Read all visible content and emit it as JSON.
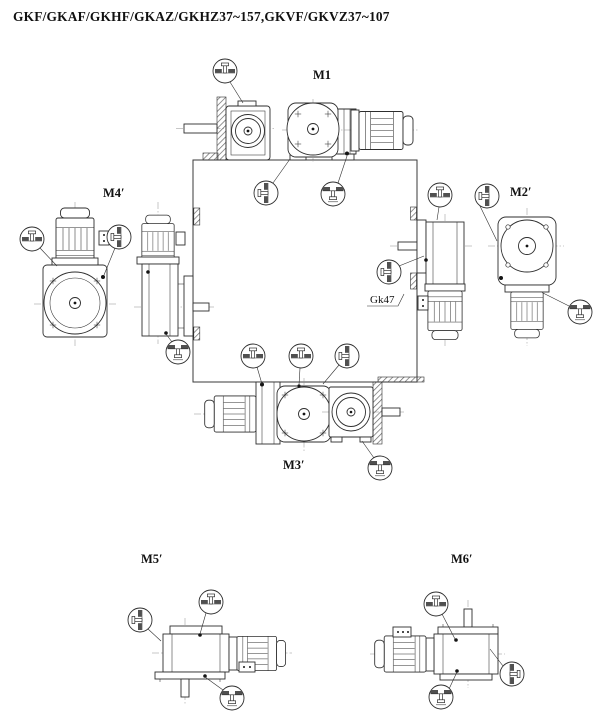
{
  "title": "GKF/GKAF/GKHF/GKAZ/GKHZ37~157,GKVF/GKVZ37~107",
  "mounting_positions": {
    "m1": "M1",
    "m2": "M2′",
    "m3": "M3′",
    "m4": "M4′",
    "m5": "M5′",
    "m6": "M6′"
  },
  "annotations": {
    "gearbox_ref": "Gk47"
  },
  "colors": {
    "line": "#2e2e2e",
    "hatch": "#666666",
    "plug_bar": "#505050",
    "background": "#ffffff",
    "text": "#111111"
  }
}
